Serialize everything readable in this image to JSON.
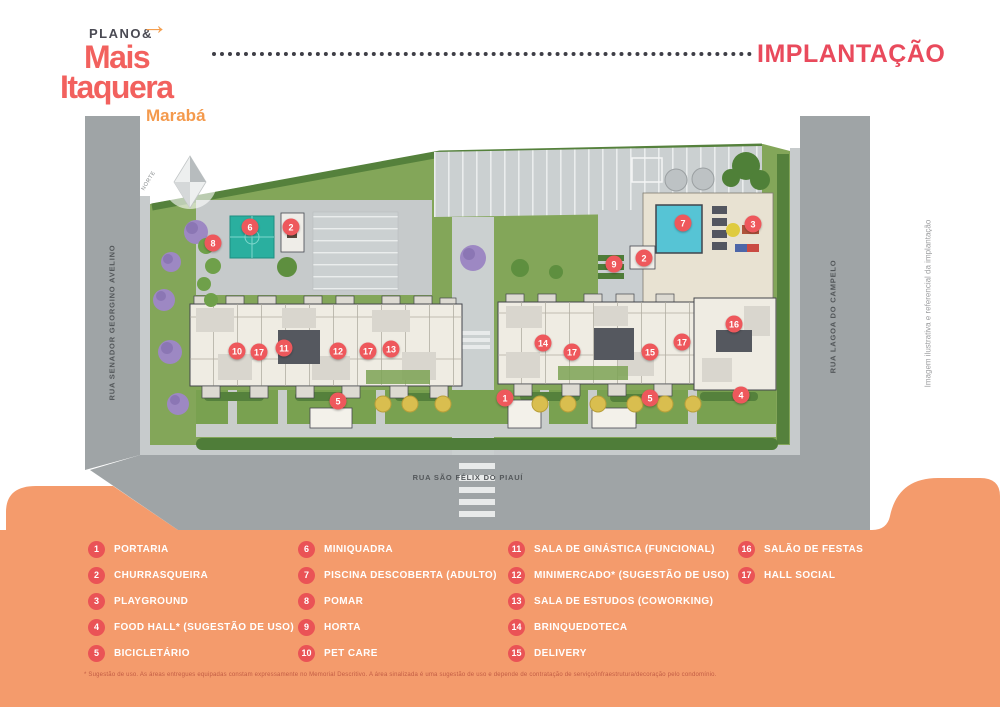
{
  "brand": {
    "plano_label": "PLANO&",
    "arrow_icon": "→",
    "name_line1": "Mais",
    "name_line2": "Itaquera",
    "name_line3": "Marabá"
  },
  "header": {
    "title": "IMPLANTAÇÃO"
  },
  "map": {
    "streets": {
      "left": "RUA SENADOR GEORGINO AVELINO",
      "right": "RUA LAGOA DO CAMPELO",
      "bottom": "RUA SÃO FÉLIX DO PIAUÍ"
    },
    "north_label": "NORTE",
    "side_note": "Imagem ilustrativa e referencial da implantação",
    "markers": [
      {
        "n": "6",
        "x": 250,
        "y": 227
      },
      {
        "n": "2",
        "x": 291,
        "y": 227
      },
      {
        "n": "8",
        "x": 213,
        "y": 243
      },
      {
        "n": "7",
        "x": 683,
        "y": 223
      },
      {
        "n": "3",
        "x": 753,
        "y": 224
      },
      {
        "n": "9",
        "x": 614,
        "y": 264
      },
      {
        "n": "2",
        "x": 644,
        "y": 258
      },
      {
        "n": "10",
        "x": 237,
        "y": 351
      },
      {
        "n": "17",
        "x": 259,
        "y": 352
      },
      {
        "n": "11",
        "x": 284,
        "y": 348
      },
      {
        "n": "12",
        "x": 338,
        "y": 351
      },
      {
        "n": "17",
        "x": 368,
        "y": 351
      },
      {
        "n": "13",
        "x": 391,
        "y": 349
      },
      {
        "n": "5",
        "x": 338,
        "y": 401
      },
      {
        "n": "14",
        "x": 543,
        "y": 343
      },
      {
        "n": "17",
        "x": 572,
        "y": 352
      },
      {
        "n": "15",
        "x": 650,
        "y": 352
      },
      {
        "n": "17",
        "x": 682,
        "y": 342
      },
      {
        "n": "16",
        "x": 734,
        "y": 324
      },
      {
        "n": "1",
        "x": 505,
        "y": 398
      },
      {
        "n": "5",
        "x": 650,
        "y": 398
      },
      {
        "n": "4",
        "x": 741,
        "y": 395
      }
    ]
  },
  "legend": {
    "columns": [
      [
        {
          "n": "1",
          "label": "PORTARIA"
        },
        {
          "n": "2",
          "label": "CHURRASQUEIRA"
        },
        {
          "n": "3",
          "label": "PLAYGROUND"
        },
        {
          "n": "4",
          "label": "FOOD HALL* (SUGESTÃO DE USO)"
        },
        {
          "n": "5",
          "label": "BICICLETÁRIO"
        }
      ],
      [
        {
          "n": "6",
          "label": "MINIQUADRA"
        },
        {
          "n": "7",
          "label": "PISCINA DESCOBERTA (ADULTO)"
        },
        {
          "n": "8",
          "label": "POMAR"
        },
        {
          "n": "9",
          "label": "HORTA"
        },
        {
          "n": "10",
          "label": "PET CARE"
        }
      ],
      [
        {
          "n": "11",
          "label": "SALA DE GINÁSTICA (FUNCIONAL)"
        },
        {
          "n": "12",
          "label": "MINIMERCADO* (SUGESTÃO DE USO)"
        },
        {
          "n": "13",
          "label": "SALA DE ESTUDOS (COWORKING)"
        },
        {
          "n": "14",
          "label": "BRINQUEDOTECA"
        },
        {
          "n": "15",
          "label": "DELIVERY"
        }
      ],
      [
        {
          "n": "16",
          "label": "SALÃO DE FESTAS"
        },
        {
          "n": "17",
          "label": "HALL SOCIAL"
        }
      ]
    ],
    "footnote": "* Sugestão de uso. As áreas entregues equipadas constam expressamente no Memorial Descritivo. A área sinalizada é uma sugestão de uso e depende de contratação de serviço/infraestrutura/decoração pelo condomínio."
  },
  "colors": {
    "brand_coral": "#F2615E",
    "brand_orange": "#F49A4D",
    "title_red": "#E94A5C",
    "panel_orange": "#F49B6C",
    "badge_red": "#EA5356",
    "road_gray": "#9FA4A6",
    "lawn_green": "#83A659",
    "pool_teal": "#56C4D5"
  }
}
